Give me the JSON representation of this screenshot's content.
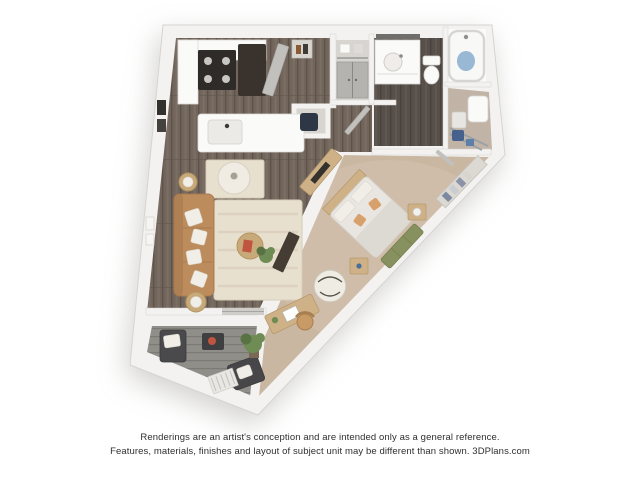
{
  "disclaimer": {
    "line1": "Renderings are an artist's conception and are intended only as a general reference.",
    "line2": "Features, materials, finishes and layout of subject unit may be different than shown. 3DPlans.com"
  },
  "palette": {
    "background": "#ffffff",
    "wall": "#f3f2f0",
    "wallEdge": "#d6d4d0",
    "wallShade": "#d8d5d0",
    "wood": "#72665c",
    "woodDark": "#5d534a",
    "woodLight": "#82766b",
    "tile": "#57504a",
    "tileDark": "#49423c",
    "tileLight": "#655c54",
    "carpet": "#c9b7a2",
    "carpetLight": "#d5c4af",
    "deck": "#908e89",
    "deckDark": "#7c7a75",
    "rug": "#e8e0cf",
    "rugStripe": "#dcd2bf",
    "sofa": "#bd8c5c",
    "sofaDark": "#a87a4e",
    "pillow": "#f1eee7",
    "woodFurn": "#cfb188",
    "woodFurnDark": "#b89a6f",
    "benchGreen": "#87915f",
    "bedding": "#e9e6e1",
    "beddingShade": "#dad6d0",
    "applianceBlack": "#2e2b29",
    "fridgeBrown": "#3a332d",
    "doorGray": "#c2c0bc",
    "closetDoorGray": "#b5b3af",
    "white": "#fafaf9",
    "navy": "#2e3745",
    "waterBlue": "#7fa8c9",
    "steel": "#9aa2a8",
    "accentRed": "#c0543f",
    "plant": "#6f8c55",
    "plantDark": "#587244",
    "wicker": "#c8a97a",
    "laundryFloor": "#c1b4a6",
    "balconyChair": "#4a4a4c",
    "textColor": "#2f2f2f"
  }
}
